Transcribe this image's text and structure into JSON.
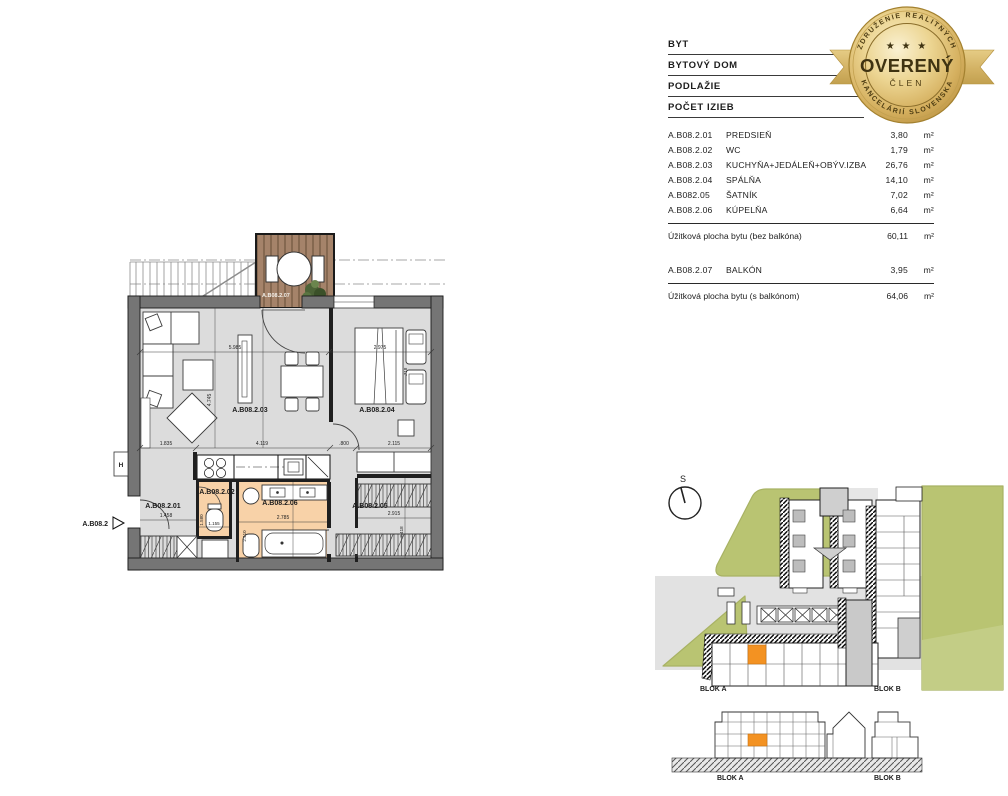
{
  "palette": {
    "wall_gray": "#757575",
    "floor_gray": "#dcdcdc",
    "room_highlight": "#f8d2a8",
    "balcony_wood": "#a5836a",
    "wood_stripe": "#7d614a",
    "site_green": "#b9c472",
    "unit_orange": "#f39222",
    "badge_gold": "#d9b967"
  },
  "spec_table": {
    "header_rows": [
      "BYT",
      "BYTOVÝ DOM",
      "PODLAŽIE",
      "POČET IZIEB"
    ],
    "rooms": [
      {
        "code": "A.B08.2.01",
        "name": "PREDSIEŇ",
        "area": "3,80",
        "unit": "m²"
      },
      {
        "code": "A.B08.2.02",
        "name": "WC",
        "area": "1,79",
        "unit": "m²"
      },
      {
        "code": "A.B08.2.03",
        "name": "KUCHYŇA+JEDÁLEŇ+OBÝV.IZBA",
        "area": "26,76",
        "unit": "m²"
      },
      {
        "code": "A.B08.2.04",
        "name": "SPÁLŇA",
        "area": "14,10",
        "unit": "m²"
      },
      {
        "code": "A.B082.05",
        "name": "ŠATNÍK",
        "area": "7,02",
        "unit": "m²"
      },
      {
        "code": "A.B08.2.06",
        "name": "KÚPELŇA",
        "area": "6,64",
        "unit": "m²"
      }
    ],
    "total_without_balcony": {
      "label": "Úžitková plocha bytu (bez balkóna)",
      "value": "60,11",
      "unit": "m²"
    },
    "balcony_row": {
      "code": "A.B08.2.07",
      "name": "BALKÓN",
      "value": "3,95",
      "unit": "m²"
    },
    "total_with_balcony": {
      "label": "Úžitková plocha bytu (s balkónom)",
      "value": "64,06",
      "unit": "m²"
    }
  },
  "badge": {
    "arc_top": "ZDRUŽENIE REALITNÝCH",
    "arc_bottom": "KANCELÁRIÍ SLOVENSKA",
    "stars": "★ ★ ★",
    "title": "OVERENÝ",
    "subtitle": "ČLEN"
  },
  "floor_plan": {
    "unit_label": "A.B08.2",
    "shaft_label": "H",
    "labels": {
      "hall": "A.B08.2.01",
      "wc": "A.B08.2.02",
      "living": "A.B08.2.03",
      "bedroom": "A.B08.2.04",
      "wardrobe": "A.B08.2.05",
      "bathroom": "A.B08.2.06",
      "balcony": "A.B08.2.07"
    },
    "dims": {
      "living_w": "5.985",
      "living_h": "4.745",
      "b1": "1.835",
      "b2": "4.119",
      "b3": ".800",
      "b4": "2.115",
      "bed_w": "2.975",
      "night": ".718",
      "hall_w": "1.458",
      "wc_w": "1.155",
      "wc_h": "1.580",
      "bath_w": "2.785",
      "bath_h": "2.410",
      "ward_w": "2.915",
      "ward_h": "2.418"
    }
  },
  "site_plan": {
    "compass": "S",
    "blok_a": "BLOK A",
    "blok_b": "BLOK B"
  },
  "elevation": {
    "blok_a": "BLOK A",
    "blok_b": "BLOK B"
  }
}
